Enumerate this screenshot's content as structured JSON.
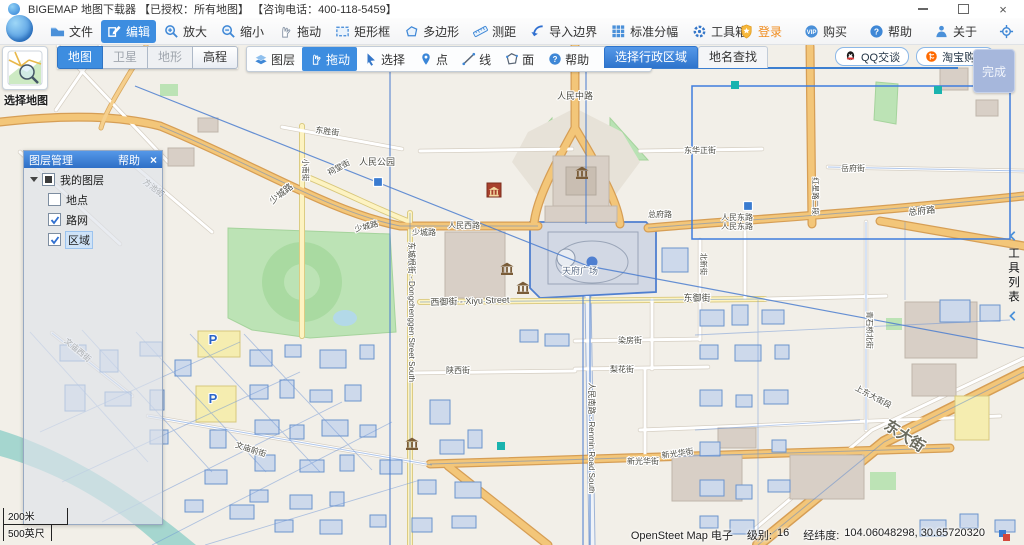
{
  "window": {
    "title": "BIGEMAP 地图下载器 【已授权：所有地图】 【咨询电话：400-118-5459】",
    "close_glyph": "×"
  },
  "toolbar_main": {
    "items": [
      {
        "name": "file-button",
        "label": "文件",
        "icon": "folder-icon"
      },
      {
        "name": "edit-button",
        "label": "编辑",
        "icon": "edit-icon",
        "active": true
      },
      {
        "name": "zoom-in-button",
        "label": "放大",
        "icon": "zoom-in-icon"
      },
      {
        "name": "zoom-out-button",
        "label": "缩小",
        "icon": "zoom-out-icon"
      },
      {
        "name": "pan-button",
        "label": "拖动",
        "icon": "hand-icon"
      },
      {
        "name": "rect-select-button",
        "label": "矩形框",
        "icon": "rectangle-icon"
      },
      {
        "name": "polygon-select-button",
        "label": "多边形",
        "icon": "polygon-icon"
      },
      {
        "name": "measure-button",
        "label": "测距",
        "icon": "ruler-icon"
      },
      {
        "name": "import-boundary-button",
        "label": "导入边界",
        "icon": "import-boundary-icon"
      },
      {
        "name": "standard-sheet-button",
        "label": "标准分幅",
        "icon": "grid-icon"
      },
      {
        "name": "toolbox-button",
        "label": "工具箱",
        "icon": "toolbox-icon"
      }
    ],
    "right_items": [
      {
        "name": "login-button",
        "label": "登录",
        "icon": "login-icon",
        "text_color": "#f08c1e"
      },
      {
        "name": "buy-button",
        "label": "购买",
        "icon": "buy-icon"
      },
      {
        "name": "help-button",
        "label": "帮助",
        "icon": "help-icon"
      },
      {
        "name": "about-button",
        "label": "关于",
        "icon": "about-icon"
      },
      {
        "name": "locate-button",
        "label": "",
        "icon": "locate-icon"
      }
    ]
  },
  "map_toolbar": {
    "select_map_label": "选择地图",
    "modes": [
      {
        "name": "mode-map",
        "label": "地图",
        "active": true
      },
      {
        "name": "mode-satellite",
        "label": "卫星",
        "disabled": true
      },
      {
        "name": "mode-terrain",
        "label": "地形",
        "disabled": true
      },
      {
        "name": "mode-elevation",
        "label": "高程"
      }
    ],
    "tools": [
      {
        "name": "tool-layers",
        "label": "图层",
        "icon": "layers-icon"
      },
      {
        "name": "tool-pan",
        "label": "拖动",
        "icon": "hand-icon",
        "active": true
      },
      {
        "name": "tool-select",
        "label": "选择",
        "icon": "cursor-icon"
      },
      {
        "name": "tool-point",
        "label": "点",
        "icon": "pin-icon"
      },
      {
        "name": "tool-line",
        "label": "线",
        "icon": "line-icon"
      },
      {
        "name": "tool-area",
        "label": "面",
        "icon": "area-icon"
      },
      {
        "name": "tool-help",
        "label": "帮助",
        "icon": "help-icon"
      },
      {
        "name": "tool-exit",
        "label": "退出",
        "icon": "exit-icon"
      }
    ],
    "tabs": [
      {
        "name": "tab-admin-region",
        "label": "选择行政区域",
        "active": true
      },
      {
        "name": "tab-place-search",
        "label": "地名查找"
      }
    ],
    "links": [
      {
        "name": "qq-chat-button",
        "label": "QQ交谈",
        "icon": "qq-icon"
      },
      {
        "name": "taobao-buy-button",
        "label": "淘宝购买",
        "icon": "taobao-icon"
      }
    ],
    "finish_label": "完成"
  },
  "layer_panel": {
    "title": "图层管理",
    "help_label": "帮助",
    "close_glyph": "×",
    "root_label": "我的图层",
    "layers": [
      {
        "label": "地点",
        "checked": false
      },
      {
        "label": "路网",
        "checked": true
      },
      {
        "label": "区域",
        "checked": true,
        "selected": true
      }
    ]
  },
  "tool_list_label": "工具列表",
  "scale_bar": {
    "metric": "200米",
    "imperial": "500英尺"
  },
  "status_bar": {
    "source": "OpenSteet Map 电子",
    "level_label": "级别:",
    "level": "16",
    "coord_label": "经纬度:",
    "coordinates": "104.06048298, 30.65720320"
  },
  "map": {
    "labels": [
      {
        "t": "人民中路",
        "x": 575,
        "y": 99
      },
      {
        "t": "东华正街",
        "x": 700,
        "y": 153,
        "s": 8
      },
      {
        "t": "人民公园",
        "x": 377,
        "y": 165
      },
      {
        "t": "东胜街",
        "x": 327,
        "y": 134,
        "r": 8,
        "s": 8
      },
      {
        "t": "少城路",
        "x": 283,
        "y": 196,
        "r": -38
      },
      {
        "t": "少城路",
        "x": 367,
        "y": 229,
        "r": -14,
        "s": 8
      },
      {
        "t": "少城路",
        "x": 424,
        "y": 235,
        "s": 8
      },
      {
        "t": "人民西路",
        "x": 464,
        "y": 228,
        "s": 8
      },
      {
        "t": "人民东路",
        "x": 737,
        "y": 220,
        "s": 8
      },
      {
        "t": "人民东路",
        "x": 737,
        "y": 229,
        "s": 8
      },
      {
        "t": "总府路",
        "x": 660,
        "y": 217,
        "s": 8
      },
      {
        "t": "总府路",
        "x": 922,
        "y": 214,
        "r": -6
      },
      {
        "t": "西御街 - Xiyu Street",
        "x": 470,
        "y": 304,
        "r": -2
      },
      {
        "t": "东御街",
        "x": 697,
        "y": 301
      },
      {
        "t": "天府广场",
        "x": 580,
        "y": 274,
        "c": "#5a6b85"
      },
      {
        "t": "东城根街 - Dongchenggen Street South",
        "x": 409,
        "y": 312,
        "r": 90,
        "s": 8
      },
      {
        "t": "人民南路 - Renmin Road South",
        "x": 589,
        "y": 438,
        "r": 90,
        "s": 8
      },
      {
        "t": "新光华街",
        "x": 643,
        "y": 464,
        "s": 8
      },
      {
        "t": "新光华街",
        "x": 678,
        "y": 456,
        "r": -8,
        "s": 8
      },
      {
        "t": "东大街",
        "x": 902,
        "y": 440,
        "r": 33,
        "s": 15,
        "b": true,
        "c": "#6b6b5e"
      },
      {
        "t": "上东大街段",
        "x": 872,
        "y": 399,
        "r": 28,
        "s": 8
      },
      {
        "t": "文庙西街",
        "x": 76,
        "y": 352,
        "r": 40,
        "s": 8
      },
      {
        "t": "文庙前街",
        "x": 250,
        "y": 452,
        "r": 18,
        "s": 8
      },
      {
        "t": "陕西街",
        "x": 458,
        "y": 373,
        "s": 8
      },
      {
        "t": "染房街",
        "x": 630,
        "y": 343,
        "s": 8
      },
      {
        "t": "梨花街",
        "x": 622,
        "y": 372,
        "s": 8
      },
      {
        "t": "北新街",
        "x": 701,
        "y": 264,
        "r": 90,
        "s": 7.5
      },
      {
        "t": "红星路二段",
        "x": 813,
        "y": 196,
        "r": 90,
        "s": 7.5
      },
      {
        "t": "岳府街",
        "x": 853,
        "y": 171,
        "s": 8
      },
      {
        "t": "方池街",
        "x": 152,
        "y": 190,
        "r": 38,
        "s": 8
      },
      {
        "t": "祠堂街",
        "x": 340,
        "y": 170,
        "r": -28,
        "s": 8
      },
      {
        "t": "小南街",
        "x": 303,
        "y": 170,
        "r": 90,
        "s": 7.5
      },
      {
        "t": "青石桥北街",
        "x": 867,
        "y": 330,
        "r": 90,
        "s": 7.5
      }
    ],
    "pois": {
      "museums": [
        [
          507,
          268
        ],
        [
          523,
          287
        ],
        [
          582,
          172
        ],
        [
          412,
          443
        ]
      ],
      "red_poi": [
        494,
        190
      ],
      "metro_stations": [
        [
          378,
          182
        ],
        [
          748,
          206
        ]
      ],
      "cyan_markers": [
        [
          735,
          85
        ],
        [
          501,
          446
        ],
        [
          938,
          90
        ]
      ],
      "parking": [
        [
          213,
          344
        ],
        [
          213,
          403
        ]
      ],
      "parking_glyph": "P"
    }
  },
  "colors": {
    "accent": "#3d8de0",
    "panel_header": "#3a7fd6",
    "login_orange": "#f08c1e",
    "finish_bg": "#a6b7dc",
    "map_bg": "#f2efe8",
    "water": "#a5d6cf",
    "park": "#bce3b5",
    "road_major": "#f3c679",
    "road_minor_yellow": "#fdf3c1",
    "vector_blue": "#4c7ecf",
    "building_blue_fill": "#cdd9eb",
    "building_gray": "#d8cfc6",
    "selection_blue": "#3f7ddd",
    "cyan_marker": "#1ab3ae"
  }
}
